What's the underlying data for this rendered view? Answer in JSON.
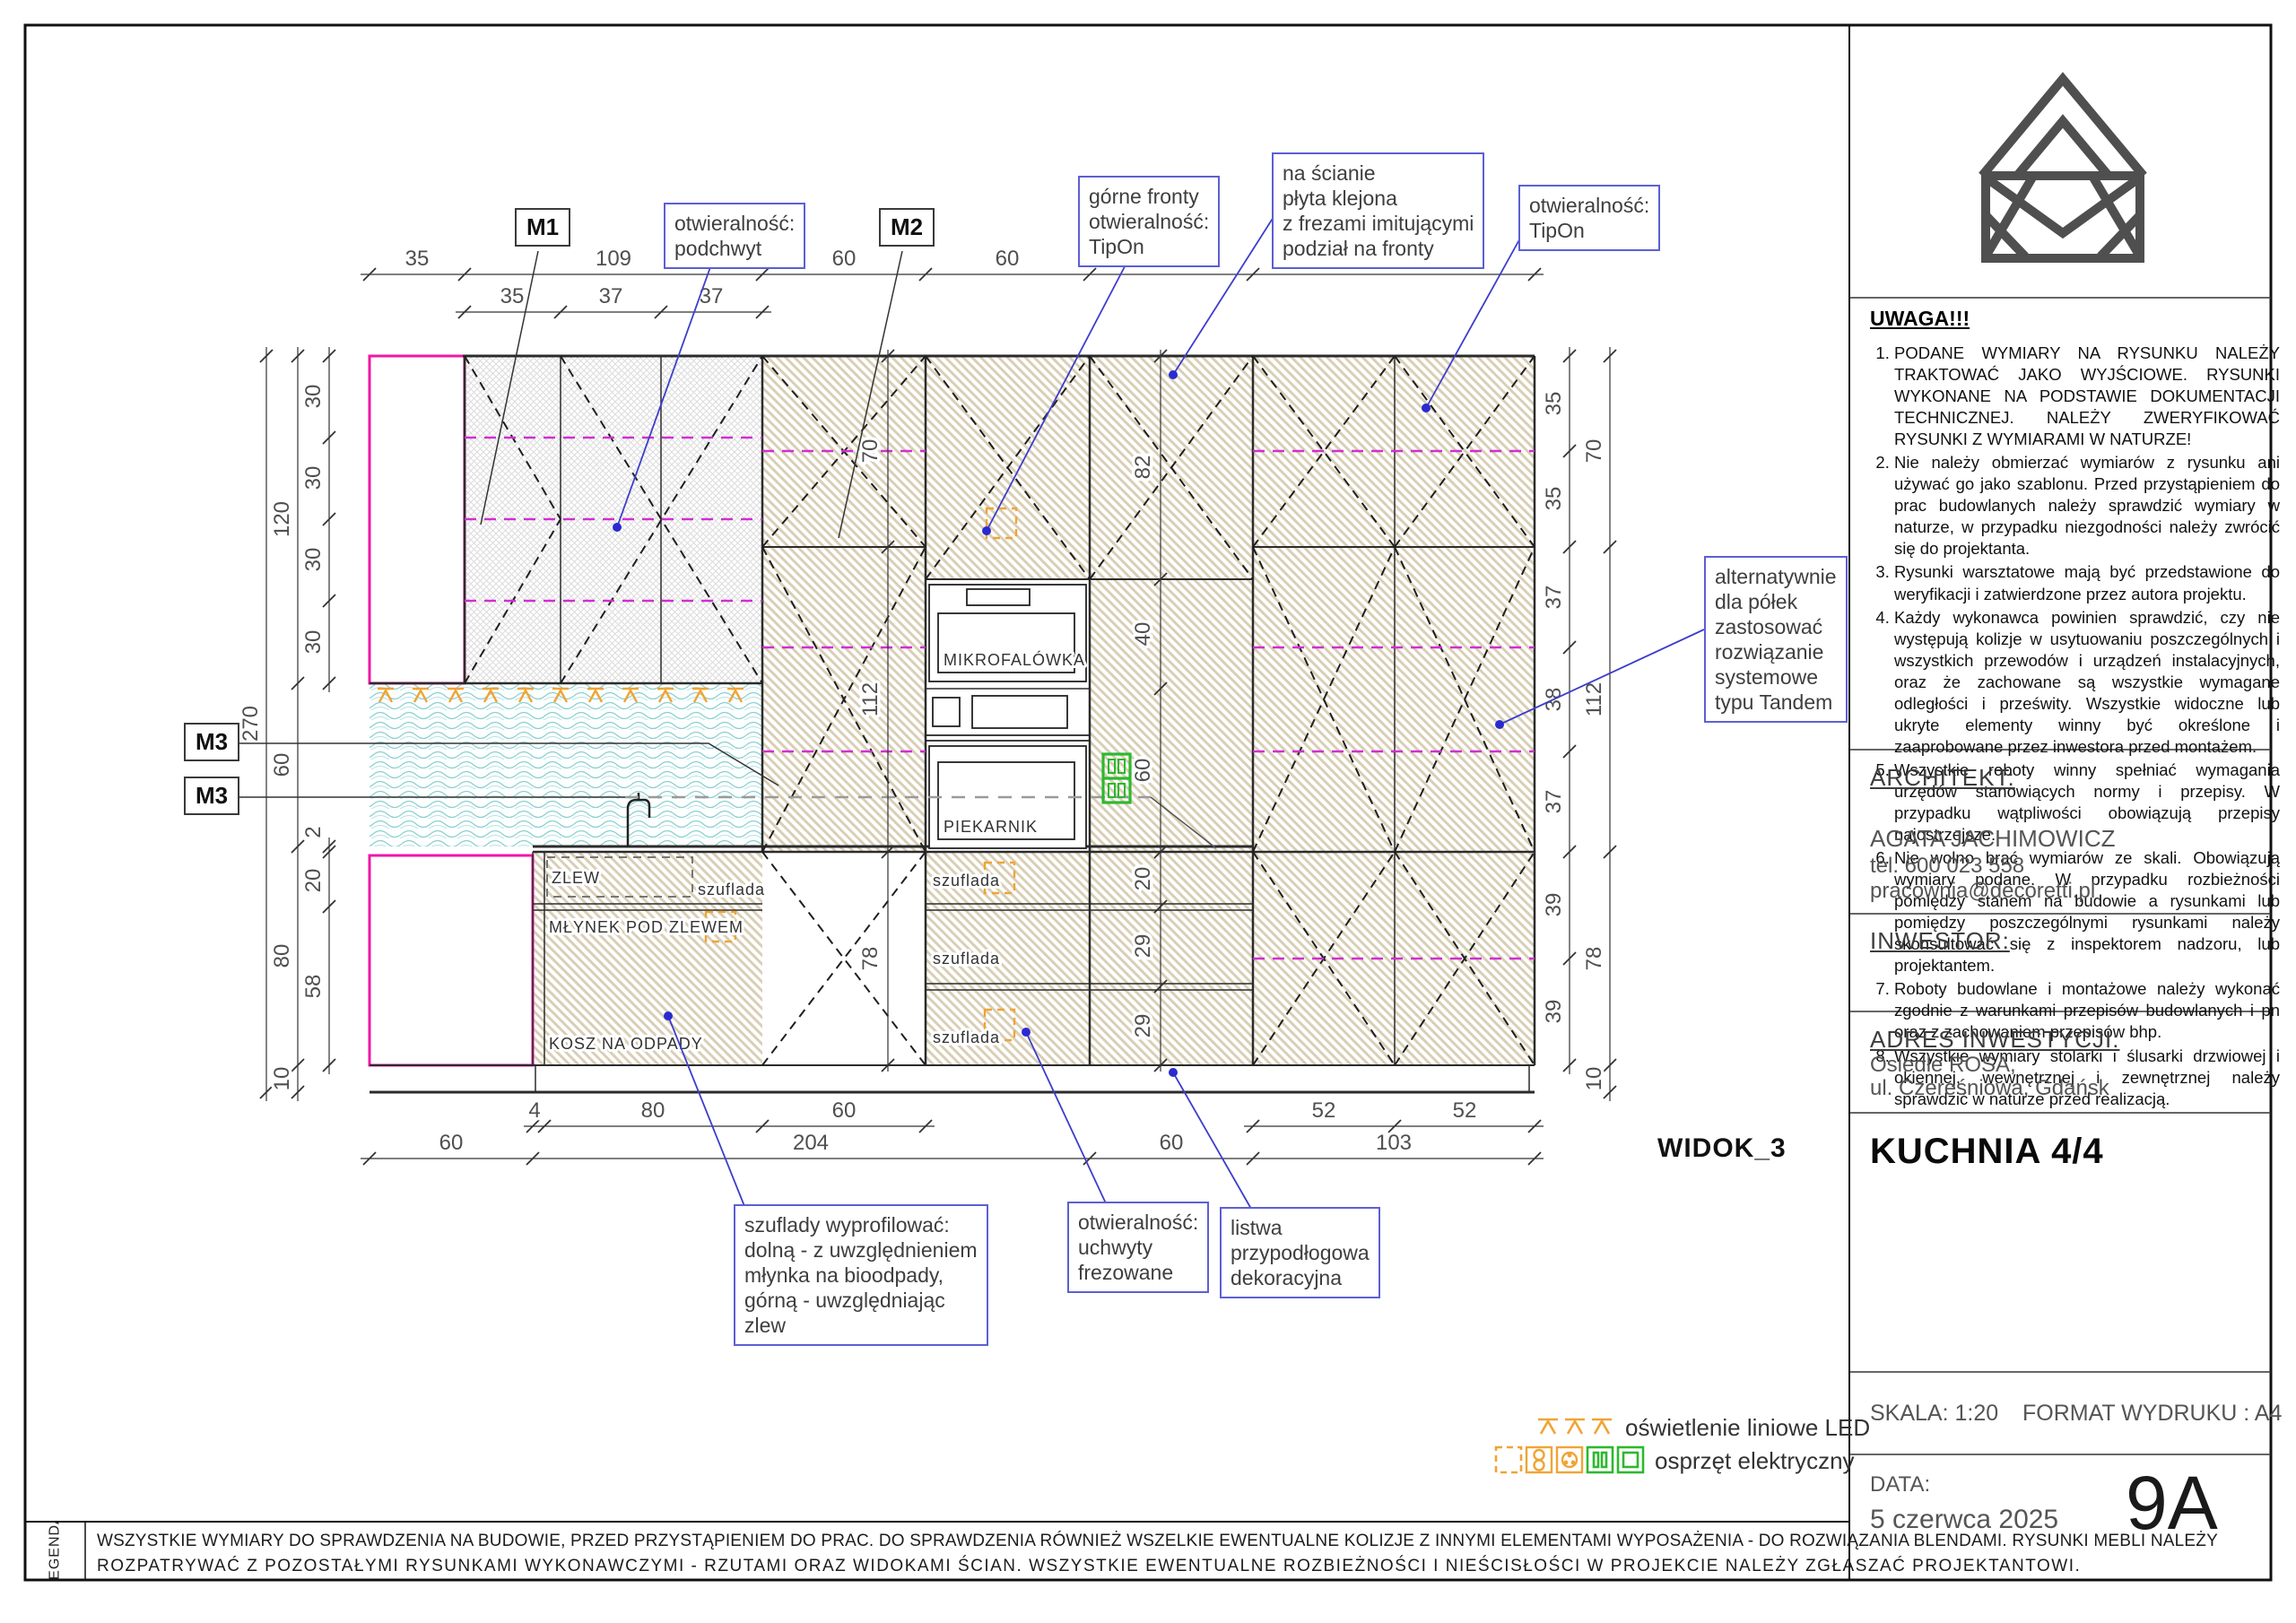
{
  "view_label": "WIDOK_3",
  "markers": {
    "m1": "M1",
    "m2": "M2",
    "m3": "M3"
  },
  "callouts": {
    "podchwyt": "otwieralność:\npodchwyt",
    "gorne_fronty": "górne fronty\notwieralność:\nTipOn",
    "na_scianie": "na ścianie\npłyta klejona\nz frezami imitującymi\npodział na fronty",
    "tipon": "otwieralność:\nTipOn",
    "tandem": "alternatywnie\ndla półek\nzastosować\nrozwiązanie\nsystemowe\ntypu Tandem",
    "szuflady": "szuflady wyprofilować:\ndolną - z uwzględnieniem\nmłynka na bioodpady,\ngórną - uwzględniając\nzlew",
    "uchwyty": "otwieralność:\nuchwyty\nfrezowane",
    "listwa": "listwa\nprzypodłogowa\ndekoracyjna"
  },
  "labels": {
    "mikrofalowka": "MIKROFALÓWKA",
    "piekarnik": "PIEKARNIK",
    "zlew": "ZLEW",
    "szuflada": "szuflada",
    "mlynek": "MŁYNEK POD ZLEWEM",
    "kosz": "KOSZ NA ODPADY"
  },
  "dims": {
    "top_main": [
      "35",
      "109",
      "60",
      "60",
      "60",
      "103"
    ],
    "top_sec": [
      "35",
      "37",
      "37"
    ],
    "bottom_sec": [
      "4",
      "80",
      "60",
      "52",
      "52"
    ],
    "bottom_main": [
      "60",
      "204",
      "60",
      "103"
    ],
    "left_outer": [
      "270"
    ],
    "left_mid": [
      "120",
      "60",
      "80",
      "10"
    ],
    "left_inner": [
      "30",
      "30",
      "30",
      "30",
      "2",
      "20",
      "58"
    ],
    "right_inner": [
      "35",
      "35",
      "37",
      "38",
      "37",
      "39",
      "39"
    ],
    "right_outer": [
      "70",
      "112",
      "78",
      "10"
    ],
    "m2_col": [
      "70",
      "112",
      "78"
    ],
    "tall_col": [
      "82",
      "40",
      "60",
      "20",
      "29",
      "29"
    ]
  },
  "legend": {
    "led": "oświetlenie liniowe LED",
    "electro": "osprzęt elektryczny"
  },
  "titleblock": {
    "uwaga_title": "UWAGA!!!",
    "notes": [
      "PODANE WYMIARY NA RYSUNKU NALEŻY TRAKTOWAĆ JAKO WYJŚCIOWE. RYSUNKI WYKONANE NA PODSTAWIE DOKUMENTACJI TECHNICZNEJ. NALEŻY ZWERYFIKOWAĆ RYSUNKI Z WYMIARAMI W NATURZE!",
      "Nie należy obmierzać wymiarów z rysunku ani używać go jako szablonu. Przed przystąpieniem do prac budowlanych należy sprawdzić wymiary w naturze, w przypadku niezgodności należy zwrócić się do projektanta.",
      "Rysunki warsztatowe mają być przedstawione do weryfikacji i zatwierdzone przez autora projektu.",
      "Każdy wykonawca powinien sprawdzić, czy nie występują kolizje w usytuowaniu poszczególnych i wszystkich przewodów i urządzeń instalacyjnych, oraz że zachowane są wszystkie wymagane odległości i prześwity. Wszystkie widoczne lub ukryte elementy winny być określone i zaaprobowane przez inwestora przed montażem.",
      "Wszystkie roboty winny spełniać wymagania urzędów stanowiących normy i przepisy. W przypadku wątpliwości obowiązują przepisy najostrzejsze.",
      "Nie wolno brać wymiarów ze skali. Obowiązują wymiary podane. W przypadku rozbieżności pomiędzy stanem na budowie a rysunkami lub pomiędzy poszczególnymi rysunkami należy skonsultować się z inspektorem nadzoru, lub projektantem.",
      "Roboty budowlane i montażowe należy wykonać zgodnie z warunkami przepisów budowlanych i pn oraz z zachowaniem przepisów bhp.",
      "Wszystkie wymiary stolarki i ślusarki drzwiowej i okiennej, wewnętrznej i zewnętrznej należy sprawdzić w naturze przed realizacją."
    ],
    "architekt_label": "ARCHITEKT:",
    "architekt_name": "AGATA JACHIMOWICZ",
    "architekt_tel": "tel. 600 023 558",
    "architekt_email": "pracownia@decoretti.pl",
    "inwestor_label": "INWESTOR:",
    "adres_label": "ADRES INWESTYCJI:",
    "adres_line1": "Osiedle ROSA,",
    "adres_line2": "ul. Czereśniowa, Gdańsk",
    "title": "KUCHNIA 4/4",
    "skala": "SKALA: 1:20",
    "format": "FORMAT WYDRUKU : A4",
    "data_label": "DATA:",
    "data_value": "5 czerwca 2025",
    "sheet": "9A"
  },
  "footer": {
    "legenda": "LEGENDA",
    "line1": "WSZYSTKIE WYMIARY DO SPRAWDZENIA NA BUDOWIE, PRZED PRZYSTĄPIENIEM DO PRAC. DO SPRAWDZENIA RÓWNIEŻ WSZELKIE EWENTUALNE KOLIZJE Z INNYMI ELEMENTAMI WYPOSAŻENIA - DO ROZWIĄZANIA BLENDAMI. RYSUNKI MEBLI NALEŻY",
    "line2": "ROZPATRYWAĆ Z POZOSTAŁYMI RYSUNKAMI WYKONAWCZYMI - RZUTAMI ORAZ WIDOKAMI ŚCIAN. WSZYSTKIE EWENTUALNE ROZBIEŻNOŚCI I NIEŚCISŁOŚCI W PROJEKCIE NALEŻY ZGŁASZAĆ PROJEKTANTOWI."
  }
}
